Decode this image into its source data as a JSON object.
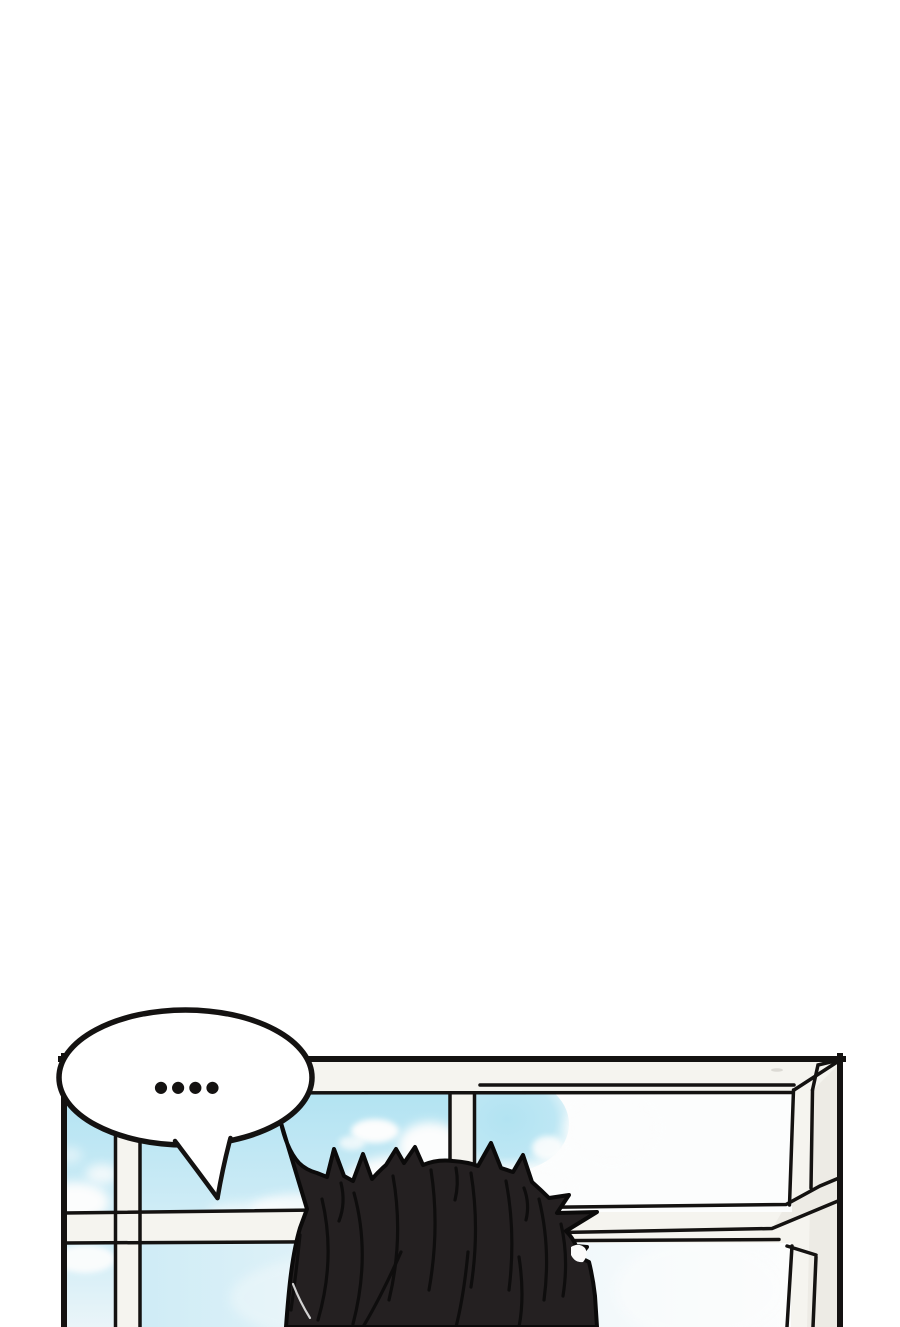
{
  "page": {
    "width": "900",
    "height": "1327",
    "background": "#ffffff"
  },
  "panel": {
    "kind": "webtoon-comic-panel",
    "speech_bubble": {
      "text": "....",
      "display_dots": "●●●●"
    },
    "scene": [
      "window-frame-with-mullions",
      "blue-sky-with-clouds",
      "back-of-head-black-spiky-hair"
    ]
  },
  "colors": {
    "ink": "#141211",
    "paper": "#ffffff",
    "frame_white": "#f5f4ef",
    "frame_shade": "#edebe5",
    "sky_blue": "#b2e3f2",
    "sky_blue_light": "#cfecf6",
    "sky_pale": "#eaf5f9",
    "cloud_white": "#fcfdfd",
    "hair_black": "#242021",
    "hair_highlight": "#fbfbfb",
    "rim_light": "#e6e6e6",
    "smudge": "#dcdad4"
  }
}
